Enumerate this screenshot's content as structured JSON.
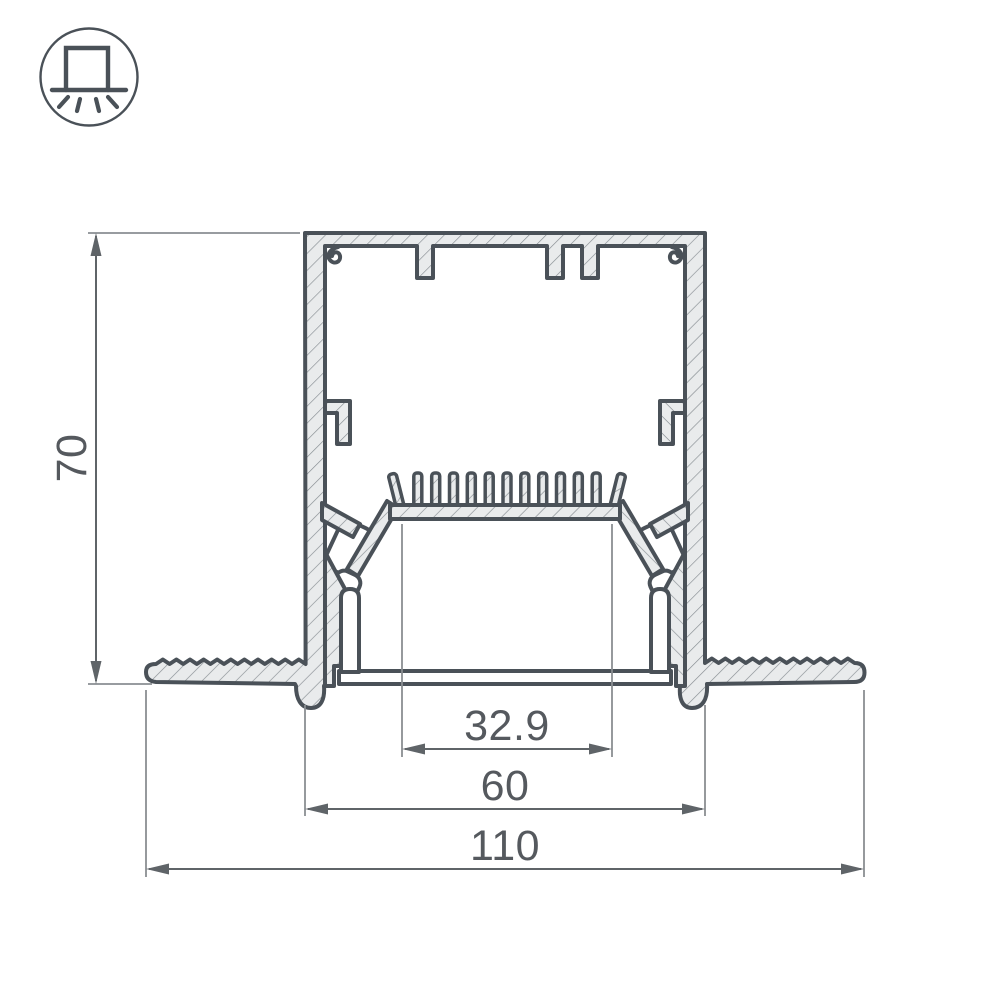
{
  "icon": {
    "name": "recessed-mount-light",
    "description": "circle badge with recessed luminaire symbol shining downward"
  },
  "drawing": {
    "subject": "recessed aluminum LED profile cross-section",
    "dimensions": {
      "height_mm": "70",
      "led_platform_width_mm": "32.9",
      "body_width_mm": "60",
      "overall_width_mm": "110"
    },
    "colors": {
      "outline": "#4a5158",
      "metal_fill": "#e9ebec",
      "hatch_line": "#878d92",
      "dimension_line": "#5f6468",
      "extension_line": "#8a8e92",
      "text": "#55595e"
    }
  }
}
